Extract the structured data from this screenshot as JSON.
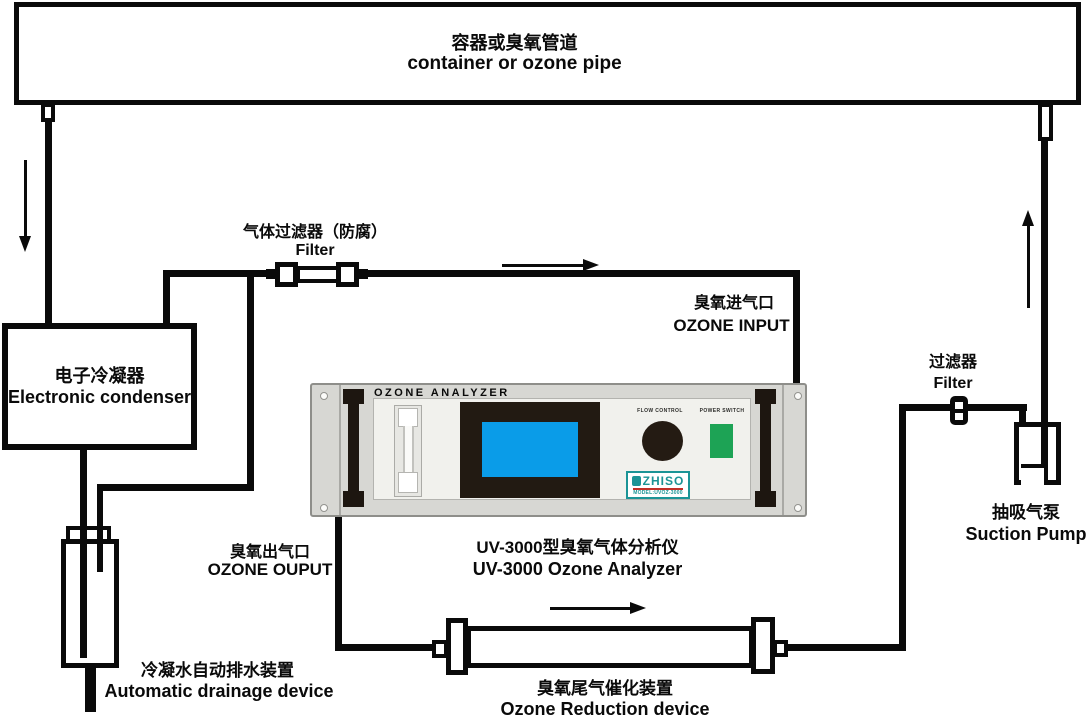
{
  "labels": {
    "container": {
      "zh": "容器或臭氧管道",
      "en": "container or ozone pipe"
    },
    "condenser": {
      "zh": "电子冷凝器",
      "en": "Electronic condenser"
    },
    "gas_filter": {
      "zh": "气体过滤器（防腐）",
      "en": "Filter"
    },
    "ozone_input": {
      "zh": "臭氧进气口",
      "en": "OZONE INPUT"
    },
    "ozone_output": {
      "zh": "臭氧出气口",
      "en": "OZONE OUPUT"
    },
    "drainage": {
      "zh": "冷凝水自动排水装置",
      "en": "Automatic drainage device"
    },
    "analyzer_caption": {
      "zh": "UV-3000型臭氧气体分析仪",
      "en": "UV-3000 Ozone Analyzer"
    },
    "reduction": {
      "zh": "臭氧尾气催化装置",
      "en": "Ozone Reduction device"
    },
    "filter2": {
      "zh": "过滤器",
      "en": "Filter"
    },
    "pump": {
      "zh": "抽吸气泵",
      "en": "Suction Pump"
    }
  },
  "panel": {
    "title": "OZONE ANALYZER",
    "flow_control": "FLOW CONTROL",
    "power_switch": "POWER SWITCH",
    "brand": "ZHISO",
    "model": "MODEL:UVOZ-3000"
  },
  "colors": {
    "line_black": "#0a0a0a",
    "panel_gray": "#d7d7d3",
    "screen_blue": "#0a9ce8",
    "bezel_dark": "#221a12",
    "switch_green": "#1da355",
    "brand_teal": "#1b9496",
    "brand_red": "#c03028"
  }
}
